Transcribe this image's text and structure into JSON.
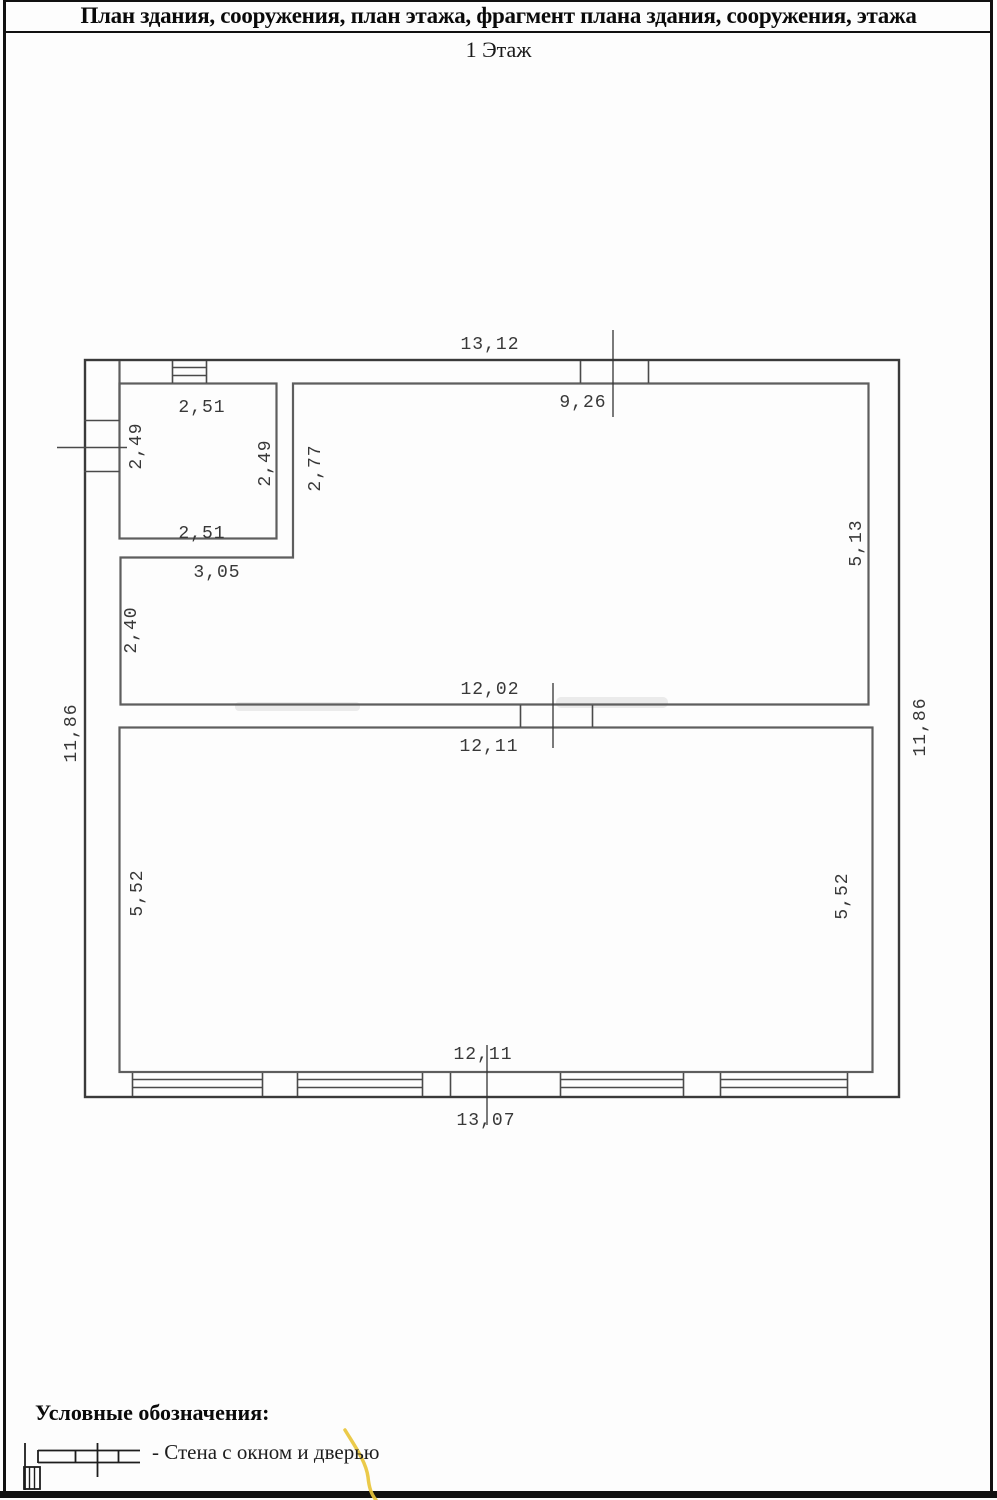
{
  "header": {
    "title": "План здания, сооружения, план этажа, фрагмент плана здания, сооружения, этажа",
    "floor_label": "1 Этаж"
  },
  "plan": {
    "dimensions": [
      {
        "text": "13,12"
      },
      {
        "text": "9,26"
      },
      {
        "text": "2,51"
      },
      {
        "text": "2,49"
      },
      {
        "text": "2,49"
      },
      {
        "text": "2,77"
      },
      {
        "text": "2,51"
      },
      {
        "text": "3,05"
      },
      {
        "text": "2,40"
      },
      {
        "text": "5,13"
      },
      {
        "text": "11,86"
      },
      {
        "text": "12,02"
      },
      {
        "text": "12,11"
      },
      {
        "text": "11,86"
      },
      {
        "text": "5,52"
      },
      {
        "text": "5,52"
      },
      {
        "text": "12,11"
      },
      {
        "text": "13,07"
      }
    ]
  },
  "legend": {
    "title": "Условные обозначения:",
    "item_label": "- Стена с окном и дверью"
  },
  "colors": {
    "outer_wall": "#3a3a3a",
    "inner_wall": "#5e5e5e",
    "annotation_mark": "#e9c53b"
  }
}
